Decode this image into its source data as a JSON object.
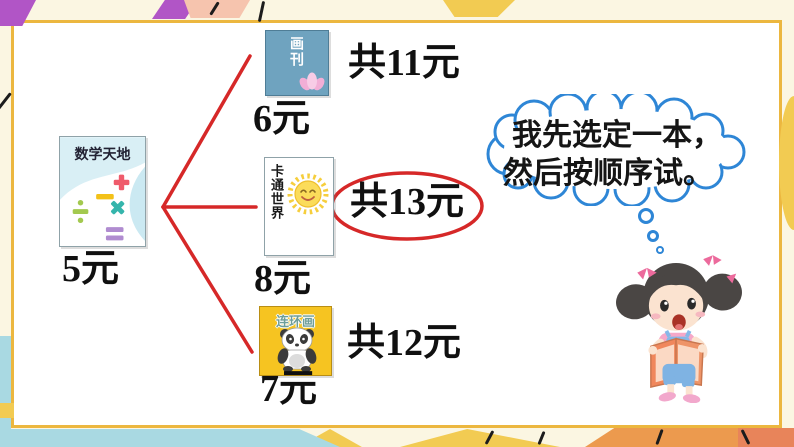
{
  "colors": {
    "outer_bg": "#FBF6E2",
    "frame": "#ECB73F",
    "connector_red": "#D62828",
    "bubble_blue": "#2E86D6",
    "comic_cover_yellow": "#F6C421",
    "pictorial_cover_blue": "#6FA3BF"
  },
  "base_book": {
    "title": "数学天地",
    "price": "5元"
  },
  "options": [
    {
      "title": "画刊",
      "total": "共11元",
      "price": "6元"
    },
    {
      "title": "卡通世界",
      "total": "共13元",
      "price": "8元"
    },
    {
      "title": "连环画",
      "total": "共12元",
      "price": "7元"
    }
  ],
  "highlight": {
    "circled_total": "共13元"
  },
  "thought_bubble": {
    "line1": "我先选定一本，",
    "line2": "然后按顺序试。"
  },
  "icons": {
    "lotus": "pink-lotus on 画刊 cover",
    "sun": "smiling-sun on 卡通世界 cover",
    "panda": "panda on 连环画 cover",
    "math_symbols": "plus minus times divide equals on 数学天地 cover",
    "mascot": "girl-reading-book"
  }
}
